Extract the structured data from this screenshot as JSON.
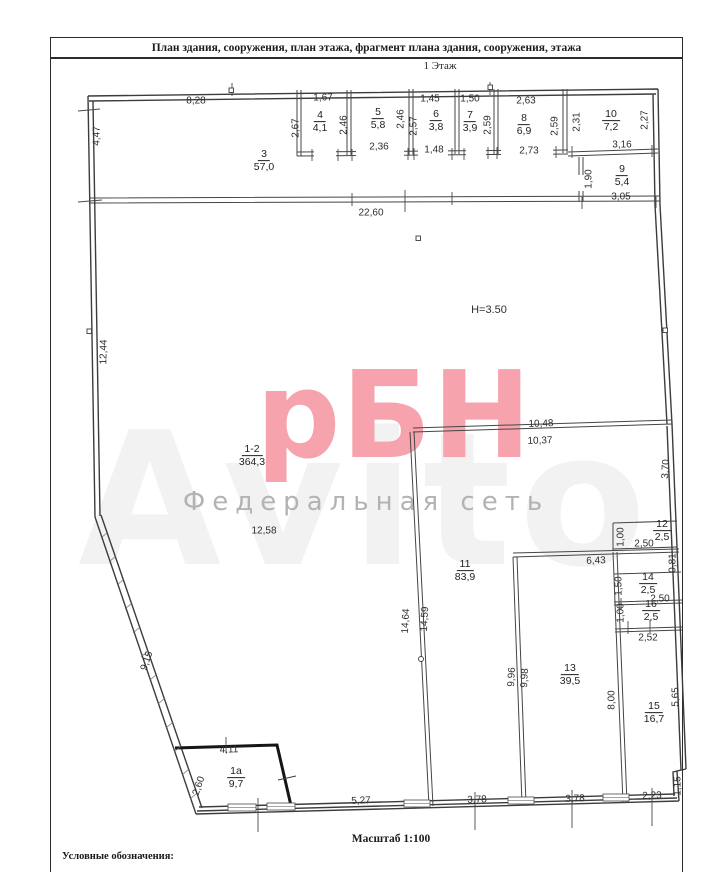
{
  "header": {
    "title": "План здания, сооружения, план этажа, фрагмент плана здания, сооружения, этажа",
    "floor": "1 Этаж"
  },
  "footer": {
    "scale": "Масштаб 1:100",
    "legend": "Условные обозначения:"
  },
  "watermark": {
    "logo": "рБН",
    "subtitle": "Федеральная сеть",
    "ghost": "Avito",
    "logo_color": "#f6a3ae",
    "subtitle_color": "#b3b3b3"
  },
  "plan": {
    "rooms": [
      {
        "n": "3",
        "a": "57,0",
        "x": 264,
        "y": 161
      },
      {
        "n": "4",
        "a": "4,1",
        "x": 320,
        "y": 122
      },
      {
        "n": "5",
        "a": "5,8",
        "x": 378,
        "y": 119
      },
      {
        "n": "6",
        "a": "3,8",
        "x": 436,
        "y": 121
      },
      {
        "n": "7",
        "a": "3,9",
        "x": 470,
        "y": 122
      },
      {
        "n": "8",
        "a": "6,9",
        "x": 524,
        "y": 125
      },
      {
        "n": "10",
        "a": "7,2",
        "x": 611,
        "y": 121
      },
      {
        "n": "9",
        "a": "5,4",
        "x": 622,
        "y": 176
      },
      {
        "n": "1-2",
        "a": "364,3",
        "x": 252,
        "y": 456
      },
      {
        "n": "12",
        "a": "2,5",
        "x": 662,
        "y": 531
      },
      {
        "n": "11",
        "a": "83,9",
        "x": 465,
        "y": 571
      },
      {
        "n": "14",
        "a": "2,5",
        "x": 648,
        "y": 584
      },
      {
        "n": "16",
        "a": "2,5",
        "x": 651,
        "y": 611
      },
      {
        "n": "13",
        "a": "39,5",
        "x": 570,
        "y": 675
      },
      {
        "n": "15",
        "a": "16,7",
        "x": 654,
        "y": 713
      },
      {
        "n": "1а",
        "a": "9,7",
        "x": 236,
        "y": 778
      }
    ],
    "dims": [
      {
        "t": "8,28",
        "x": 196,
        "y": 101
      },
      {
        "t": "4,47",
        "x": 97,
        "y": 136,
        "r": -89
      },
      {
        "t": "1,67",
        "x": 323,
        "y": 98
      },
      {
        "t": "2,67",
        "x": 296,
        "y": 128,
        "r": -90
      },
      {
        "t": "2,46",
        "x": 344,
        "y": 125,
        "r": -90
      },
      {
        "t": "2,36",
        "x": 379,
        "y": 147
      },
      {
        "t": "2,46",
        "x": 401,
        "y": 119,
        "r": -90
      },
      {
        "t": "1,45",
        "x": 430,
        "y": 99
      },
      {
        "t": "2,57",
        "x": 414,
        "y": 126,
        "r": -90
      },
      {
        "t": "1,48",
        "x": 434,
        "y": 150
      },
      {
        "t": "1,50",
        "x": 470,
        "y": 99
      },
      {
        "t": "2,59",
        "x": 488,
        "y": 125,
        "r": -90
      },
      {
        "t": "2,63",
        "x": 526,
        "y": 101
      },
      {
        "t": "2,59",
        "x": 555,
        "y": 126,
        "r": -90
      },
      {
        "t": "2,73",
        "x": 529,
        "y": 151
      },
      {
        "t": "2,31",
        "x": 577,
        "y": 122,
        "r": -90
      },
      {
        "t": "2,27",
        "x": 645,
        "y": 120,
        "r": -90
      },
      {
        "t": "3,16",
        "x": 622,
        "y": 145
      },
      {
        "t": "1,90",
        "x": 589,
        "y": 179,
        "r": -90
      },
      {
        "t": "3,05",
        "x": 621,
        "y": 197
      },
      {
        "t": "22,60",
        "x": 371,
        "y": 213
      },
      {
        "t": "12,44",
        "x": 104,
        "y": 352,
        "r": -89
      },
      {
        "t": "H=3.50",
        "x": 489,
        "y": 310,
        "fs": 11
      },
      {
        "t": "10,48",
        "x": 541,
        "y": 424,
        "r": -2
      },
      {
        "t": "10,37",
        "x": 540,
        "y": 441,
        "r": -2
      },
      {
        "t": "3,70",
        "x": 666,
        "y": 469,
        "r": -87
      },
      {
        "t": "12,58",
        "x": 264,
        "y": 531
      },
      {
        "t": "1,00",
        "x": 621,
        "y": 537,
        "r": -90
      },
      {
        "t": "2,50",
        "x": 644,
        "y": 544
      },
      {
        "t": "0,81",
        "x": 673,
        "y": 563,
        "r": -90
      },
      {
        "t": "6,43",
        "x": 596,
        "y": 561,
        "r": -2
      },
      {
        "t": "1,50",
        "x": 619,
        "y": 586,
        "r": -90
      },
      {
        "t": "2,50",
        "x": 660,
        "y": 599
      },
      {
        "t": "1,00",
        "x": 621,
        "y": 613,
        "r": -90
      },
      {
        "t": "2,52",
        "x": 648,
        "y": 638
      },
      {
        "t": "14,64",
        "x": 406,
        "y": 621,
        "r": -87
      },
      {
        "t": "14,59",
        "x": 425,
        "y": 619,
        "r": -87
      },
      {
        "t": "9,96",
        "x": 512,
        "y": 677,
        "r": -87
      },
      {
        "t": "9,98",
        "x": 525,
        "y": 678,
        "r": -87
      },
      {
        "t": "8,00",
        "x": 612,
        "y": 700,
        "r": -90
      },
      {
        "t": "5,65",
        "x": 676,
        "y": 697,
        "r": -90
      },
      {
        "t": "1,15",
        "x": 678,
        "y": 786,
        "r": -90
      },
      {
        "t": "2,23",
        "x": 652,
        "y": 796,
        "r": -2
      },
      {
        "t": "9,15",
        "x": 147,
        "y": 661,
        "r": -71
      },
      {
        "t": "4,11",
        "x": 229,
        "y": 750,
        "r": -2
      },
      {
        "t": "2,60",
        "x": 199,
        "y": 786,
        "r": -71
      },
      {
        "t": "5,27",
        "x": 361,
        "y": 801,
        "r": -2
      },
      {
        "t": "3,78",
        "x": 477,
        "y": 800,
        "r": -2
      },
      {
        "t": "3,78",
        "x": 575,
        "y": 799,
        "r": -2
      }
    ]
  }
}
